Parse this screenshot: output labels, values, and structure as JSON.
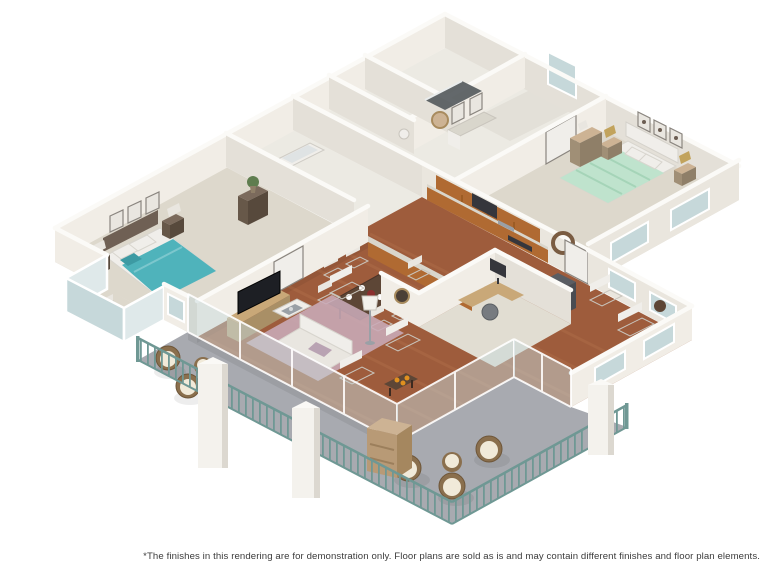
{
  "page": {
    "width": 764,
    "height": 573,
    "background": "#ffffff"
  },
  "footer": {
    "disclaimer": "*The finishes in this rendering are for demonstration only. Floor plans are sold as is and may contain different finishes and floor plan elements."
  },
  "scene": {
    "type": "isometric-3d-floor-plan-rendering",
    "rooms": [
      "master-bedroom",
      "master-bathroom",
      "second-bathroom",
      "walk-in-closet",
      "hallway",
      "kitchen",
      "dining-area",
      "living-room",
      "office-den",
      "second-bedroom",
      "window-wing",
      "wrap-around-balcony",
      "bay-window"
    ]
  },
  "colors": {
    "page": "#ffffff",
    "wall": "#f1ede6",
    "wallsh": "#e4e0d8",
    "wallmid": "#eae6de",
    "walltop": "#fbfaf7",
    "carpet": "#ddd8cc",
    "carpet2": "#e1ddd2",
    "tile": "#eceae3",
    "tile2": "#e3e0d8",
    "wood": "#9e5c3c",
    "wood2": "#b06f4a",
    "balcony": "#a8aab0",
    "railing": "#6f9894",
    "glass": "#c6d8da",
    "glassL": "#dfe9ea",
    "white": "#f0eeea",
    "cream": "#e9e6e0",
    "teal": "#4fb3bb",
    "tealD": "#3d9aa3",
    "mint": "#bfe3cd",
    "mintS": "#a5d4b8",
    "headboard": "#6f6054",
    "darkwood": "#5d4636",
    "rug": "#c9abb8",
    "mauve": "#b9a3b3",
    "tv": "#1d1f24",
    "cab": "#b06a32",
    "counter": "#d9d6cc",
    "appl": "#35363c",
    "desk": "#c9a878",
    "tan": "#cdb394",
    "wicker": "#8a6f4d",
    "cushion": "#f1ead9",
    "gold": "#c2a35c",
    "plant": "#5f7d4f",
    "steel": "#9aa0a6",
    "text": "#3b3b3b"
  }
}
